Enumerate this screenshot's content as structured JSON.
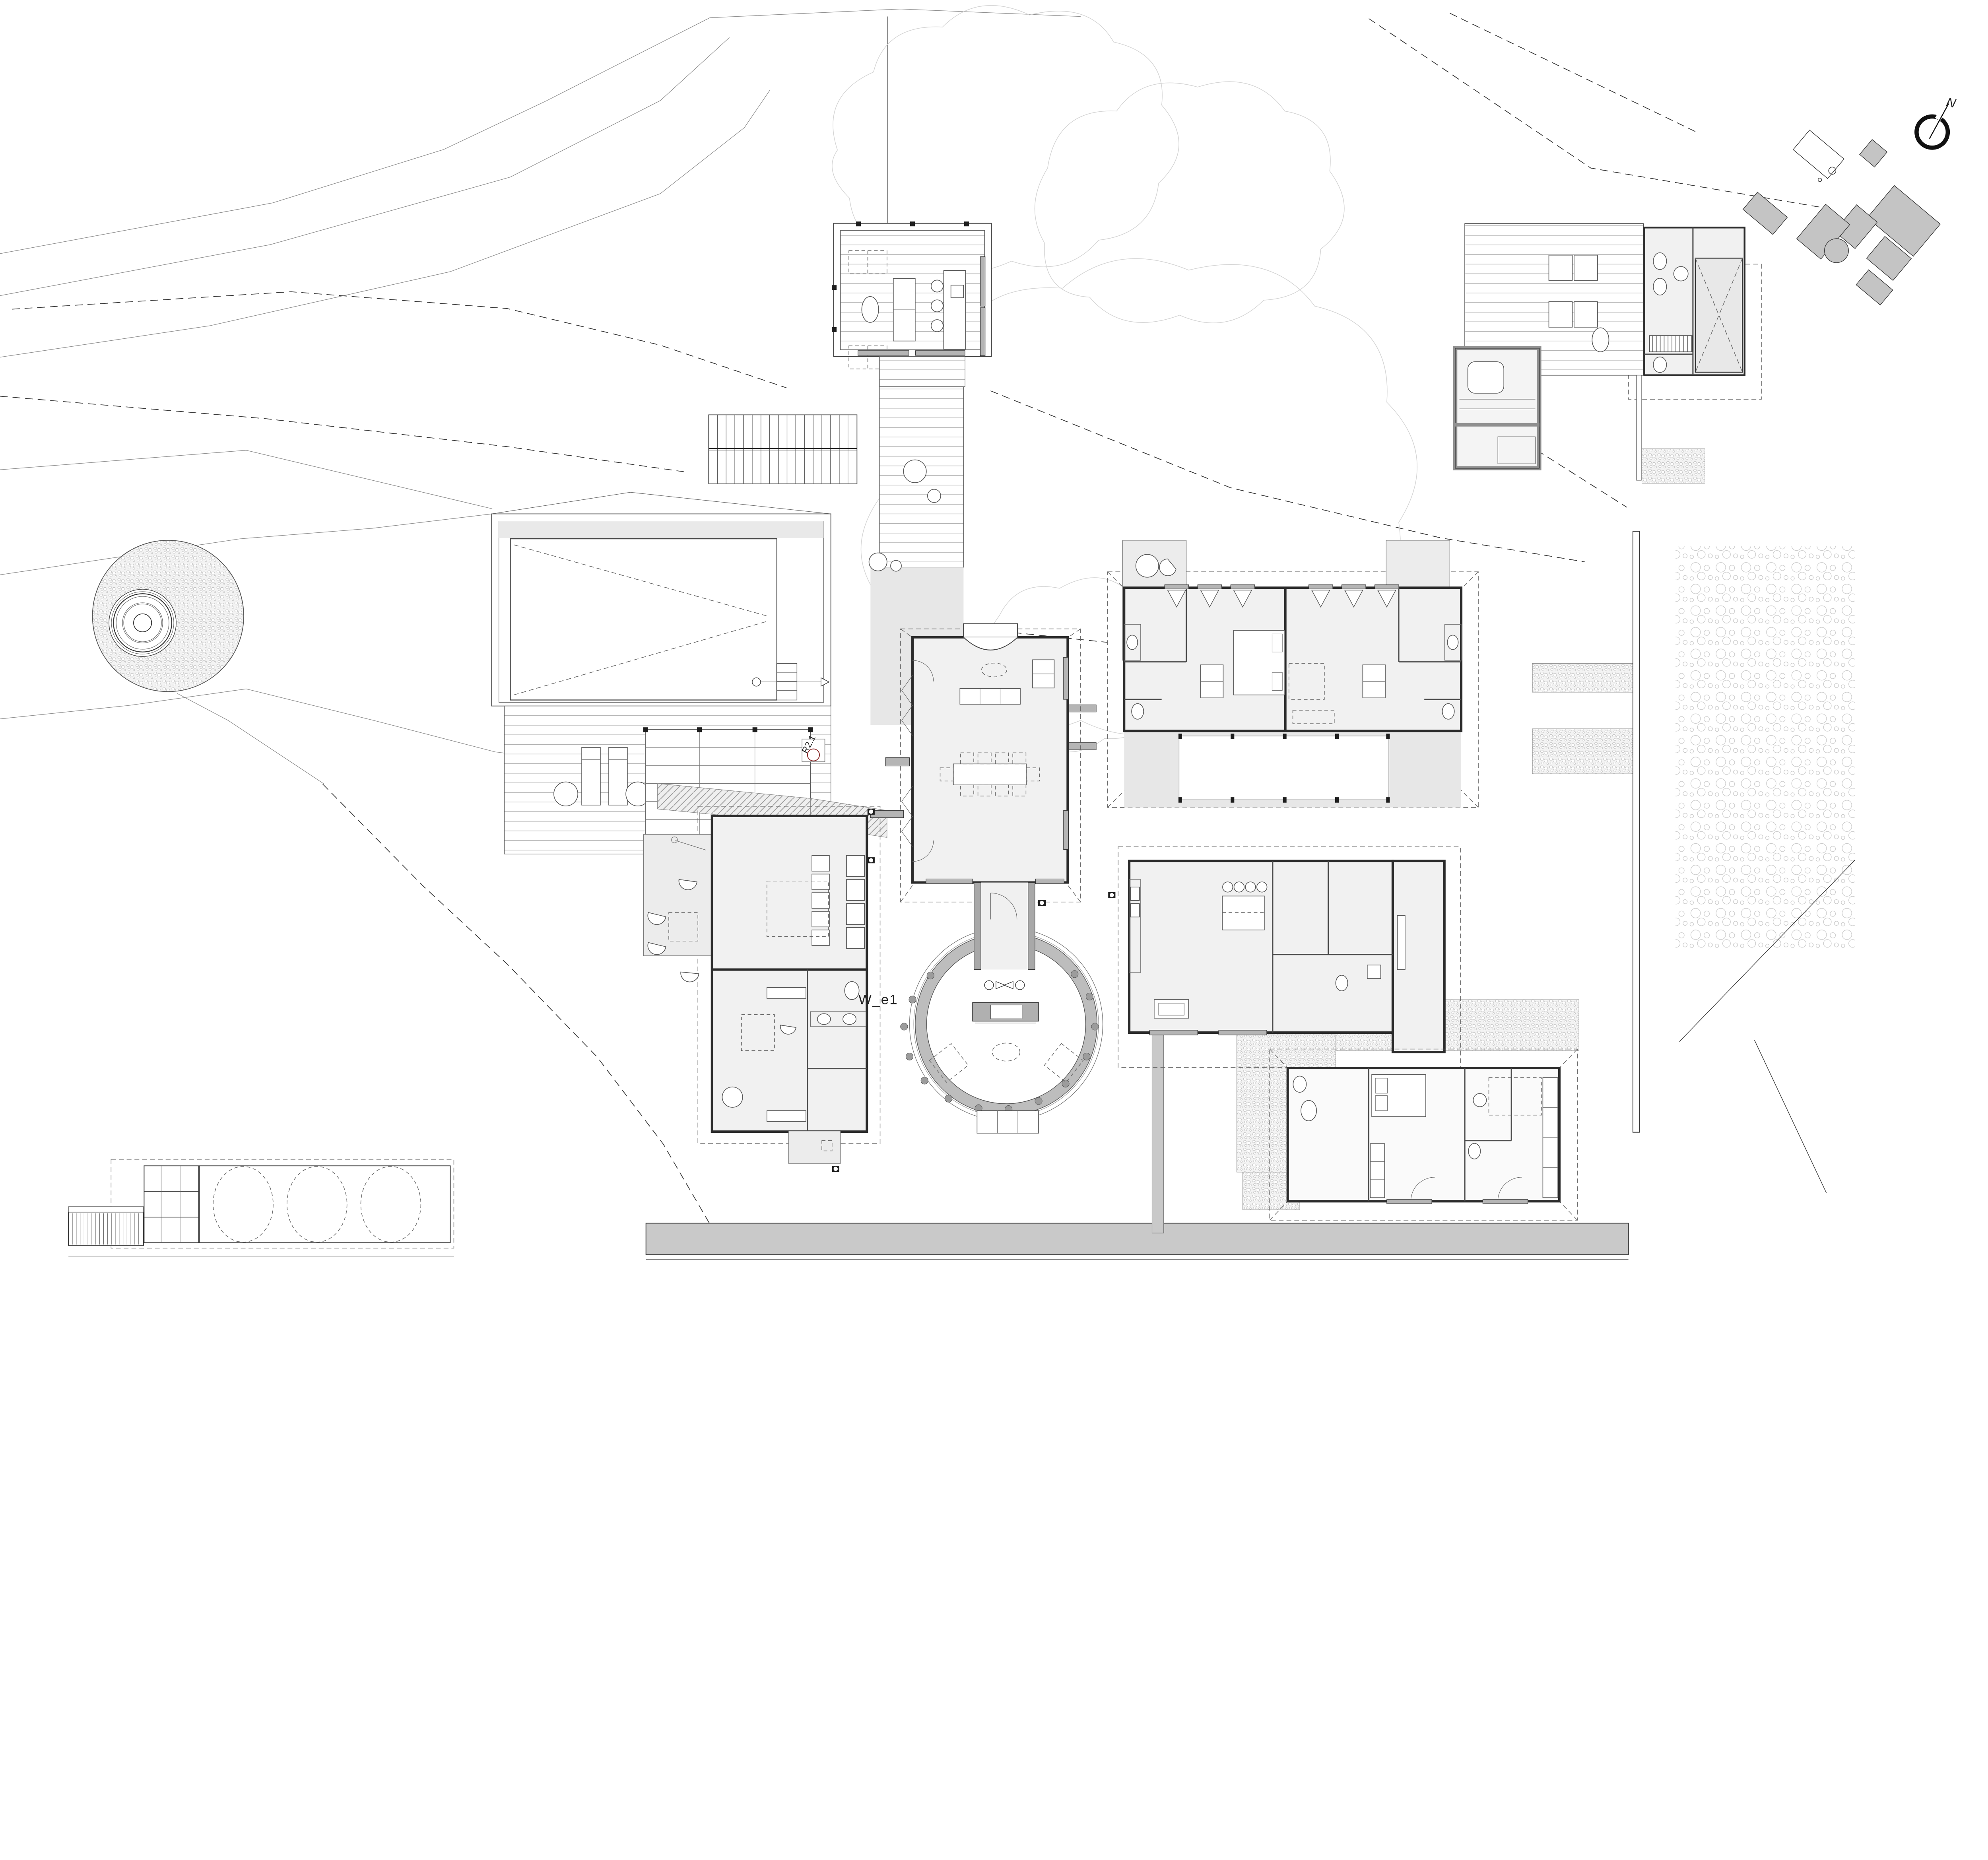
{
  "document": {
    "type": "architectural-site-plan",
    "description_visible_text_only": true
  },
  "labels": {
    "north": "N",
    "room_label_1": "W_e1",
    "section_marker_1": "R2.1"
  },
  "colors": {
    "paper": "#ffffff",
    "ink": "#2b2b2b",
    "contour": "#8f8f8f",
    "tree": "#d4d4d4",
    "room_fill": "#f1f1f1",
    "veranda_fill": "#e7e7e7",
    "terrace_fill": "#ececec",
    "sill_gray": "#b5b5b5",
    "ring_gray": "#bdbdbd",
    "road_gray": "#c9c9c9",
    "keyplan_gray": "#c4c4c4",
    "marker_red": "#8a2a2a"
  },
  "features": [
    "contour-lines",
    "tree-canopies",
    "water-tank-circle",
    "lap-pool",
    "pool-deck",
    "outdoor-stair",
    "timber-boardwalk",
    "studio-pavilion",
    "guest-bath-pavilion",
    "sauna",
    "plunge-pool",
    "main-hall",
    "round-courtyard",
    "west-wing",
    "bedroom-wing",
    "kitchen-wing",
    "guest-house",
    "tank-shed",
    "access-road",
    "orchard-field",
    "boundary-wall",
    "key-plan",
    "north-arrow"
  ]
}
